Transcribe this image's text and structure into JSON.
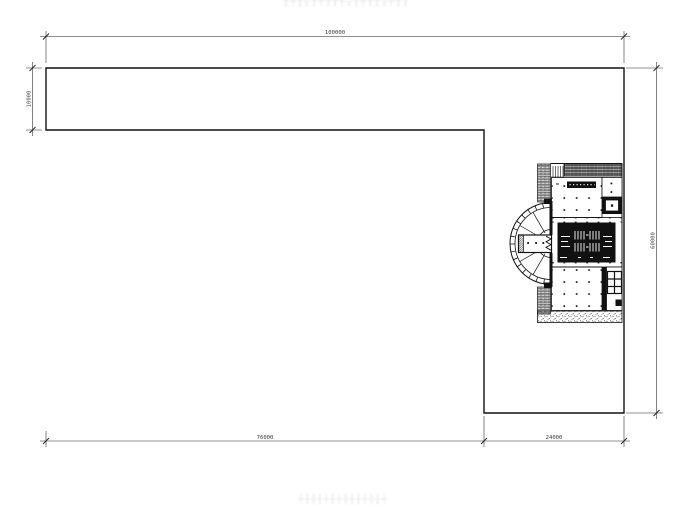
{
  "drawing": {
    "top_caption": "╫╪╂╬╫╪╫╂╪╬╫╪╂╫╬╪╫╂",
    "bottom_caption": "╪╫╬╂╪╫╪╬╫╂╪╬╫╪",
    "dimensions": {
      "overall_width": "100000",
      "left_strip_height": "10000",
      "overall_height": "60000",
      "bottom_left_width": "76000",
      "bottom_right_width": "24000"
    },
    "colors": {
      "line": "#1a1a1a",
      "dim_text": "#3a3a3a",
      "caption": "#ebebeb",
      "background": "#ffffff"
    }
  }
}
